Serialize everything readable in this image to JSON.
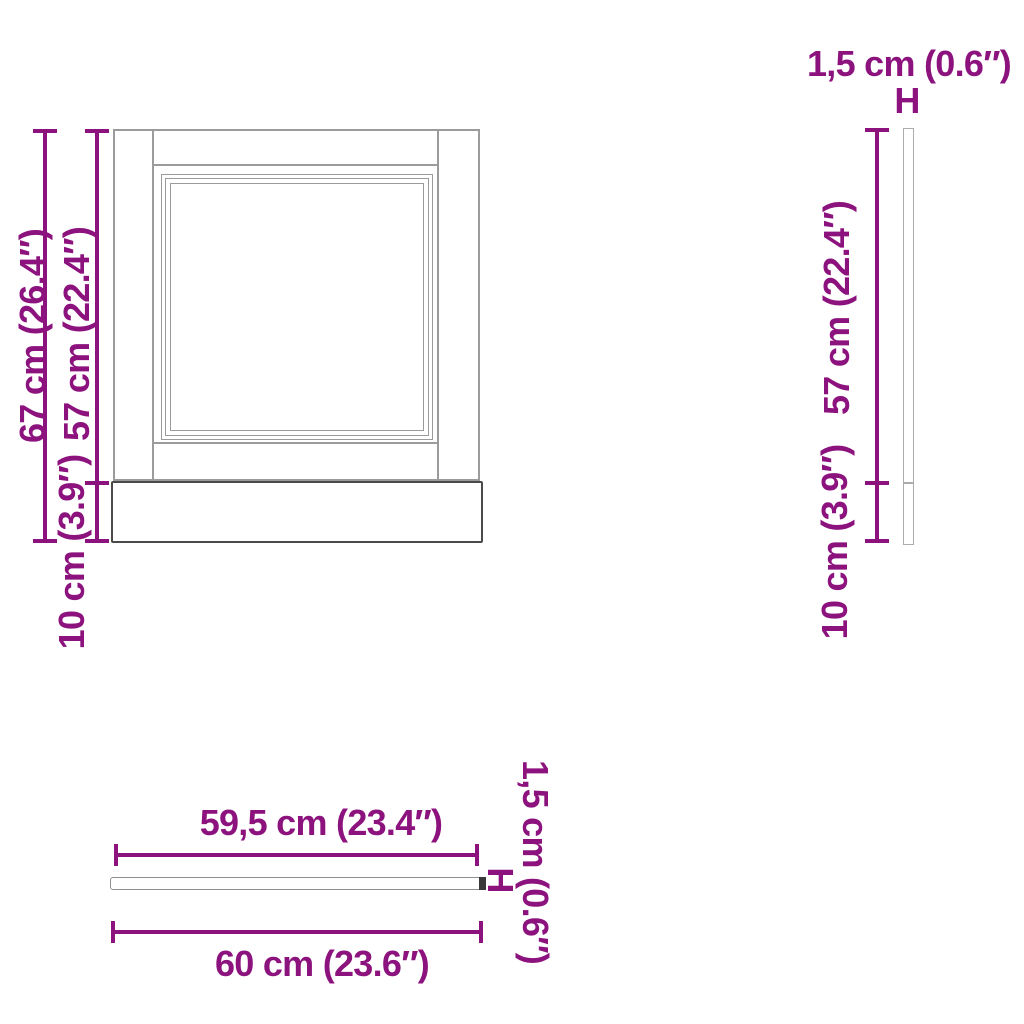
{
  "diagram_type": "furniture-dimension-drawing",
  "colors": {
    "accent": "#8C127E",
    "line_light": "#9B9B9B",
    "line_panel": "#ACACAC",
    "line_dark": "#4A4A4A",
    "end_cap": "#3A3A3A",
    "background": "#FFFFFF"
  },
  "front_view": {
    "total_height_label": "67 cm (26.4″)",
    "door_height_label": "57 cm (22.4″)",
    "plinth_height_label": "10 cm (3.9″)"
  },
  "side_view": {
    "thickness_label": "1,5 cm (0.6″)",
    "height_symbol": "H",
    "door_height_label": "57 cm (22.4″)",
    "plinth_height_label": "10 cm (3.9″)"
  },
  "top_view": {
    "inner_width_label": "59,5 cm (23.4″)",
    "total_width_label": "60 cm (23.6″)",
    "thickness_label": "1,5 cm (0.6″)",
    "width_symbol": "H"
  }
}
